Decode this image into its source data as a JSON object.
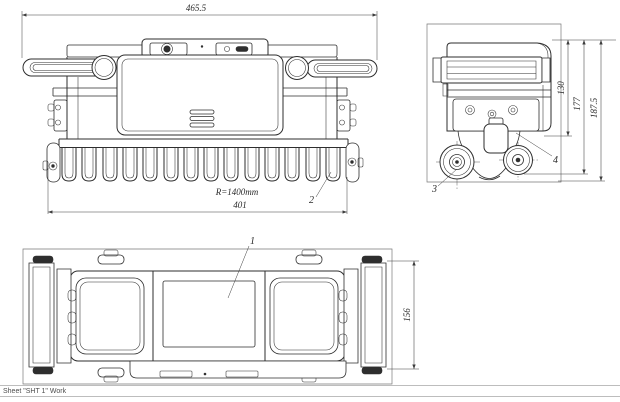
{
  "drawing": {
    "front_view": {
      "dim_overall_width": "465.5",
      "dim_brush_width": "401",
      "radius_annotation": "R=1400mm",
      "callout_brush": "2"
    },
    "side_view": {
      "dim_handle_height": "130",
      "dim_body_height": "177",
      "dim_overall_height": "187.5",
      "callout_wheel": "3",
      "callout_body": "4"
    },
    "top_view": {
      "dim_depth": "156",
      "callout_screen": "1"
    },
    "colors": {
      "line": "#2e2e2e",
      "dimension": "#3c3c3c",
      "background": "#ffffff",
      "status_divider": "#bdbdbd",
      "status_text": "#4d4d4d"
    }
  },
  "status_bar": {
    "sheet_label": "Sheet \"SHT 1\" Work"
  }
}
